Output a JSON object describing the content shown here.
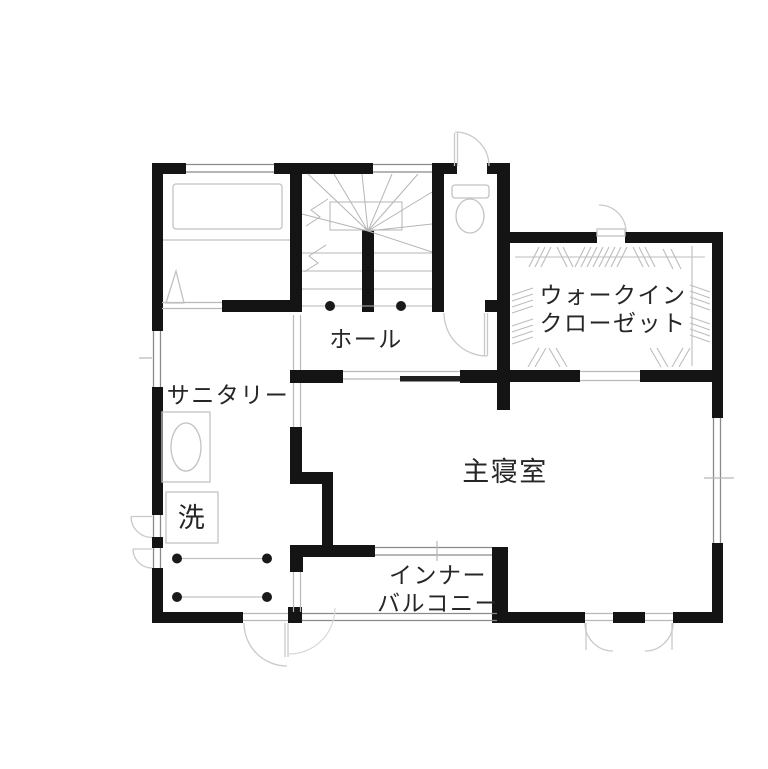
{
  "floor_plan": {
    "rooms": {
      "walk_in_closet": {
        "line1": "ウォークイン",
        "line2": "クローゼット"
      },
      "hall": {
        "label": "ホール"
      },
      "sanitary": {
        "label": "サニタリー"
      },
      "laundry": {
        "label": "洗"
      },
      "master_bedroom": {
        "label": "主寝室"
      },
      "inner_balcony": {
        "line1": "インナー",
        "line2": "バルコニー"
      }
    },
    "fixtures": [
      "bathtub",
      "bathroom-folding-door",
      "staircase",
      "toilet",
      "washbasin",
      "washing-machine-space",
      "laundry-drying-poles",
      "closet-hanger-rods"
    ],
    "colors": {
      "wall": "#141414",
      "window_line": "#8a8a8a",
      "thin_line": "#b8b8b8",
      "door_arc": "#c9c9c9",
      "fixture_line": "#c2c2c2",
      "text": "#262626",
      "background": "#ffffff"
    }
  }
}
